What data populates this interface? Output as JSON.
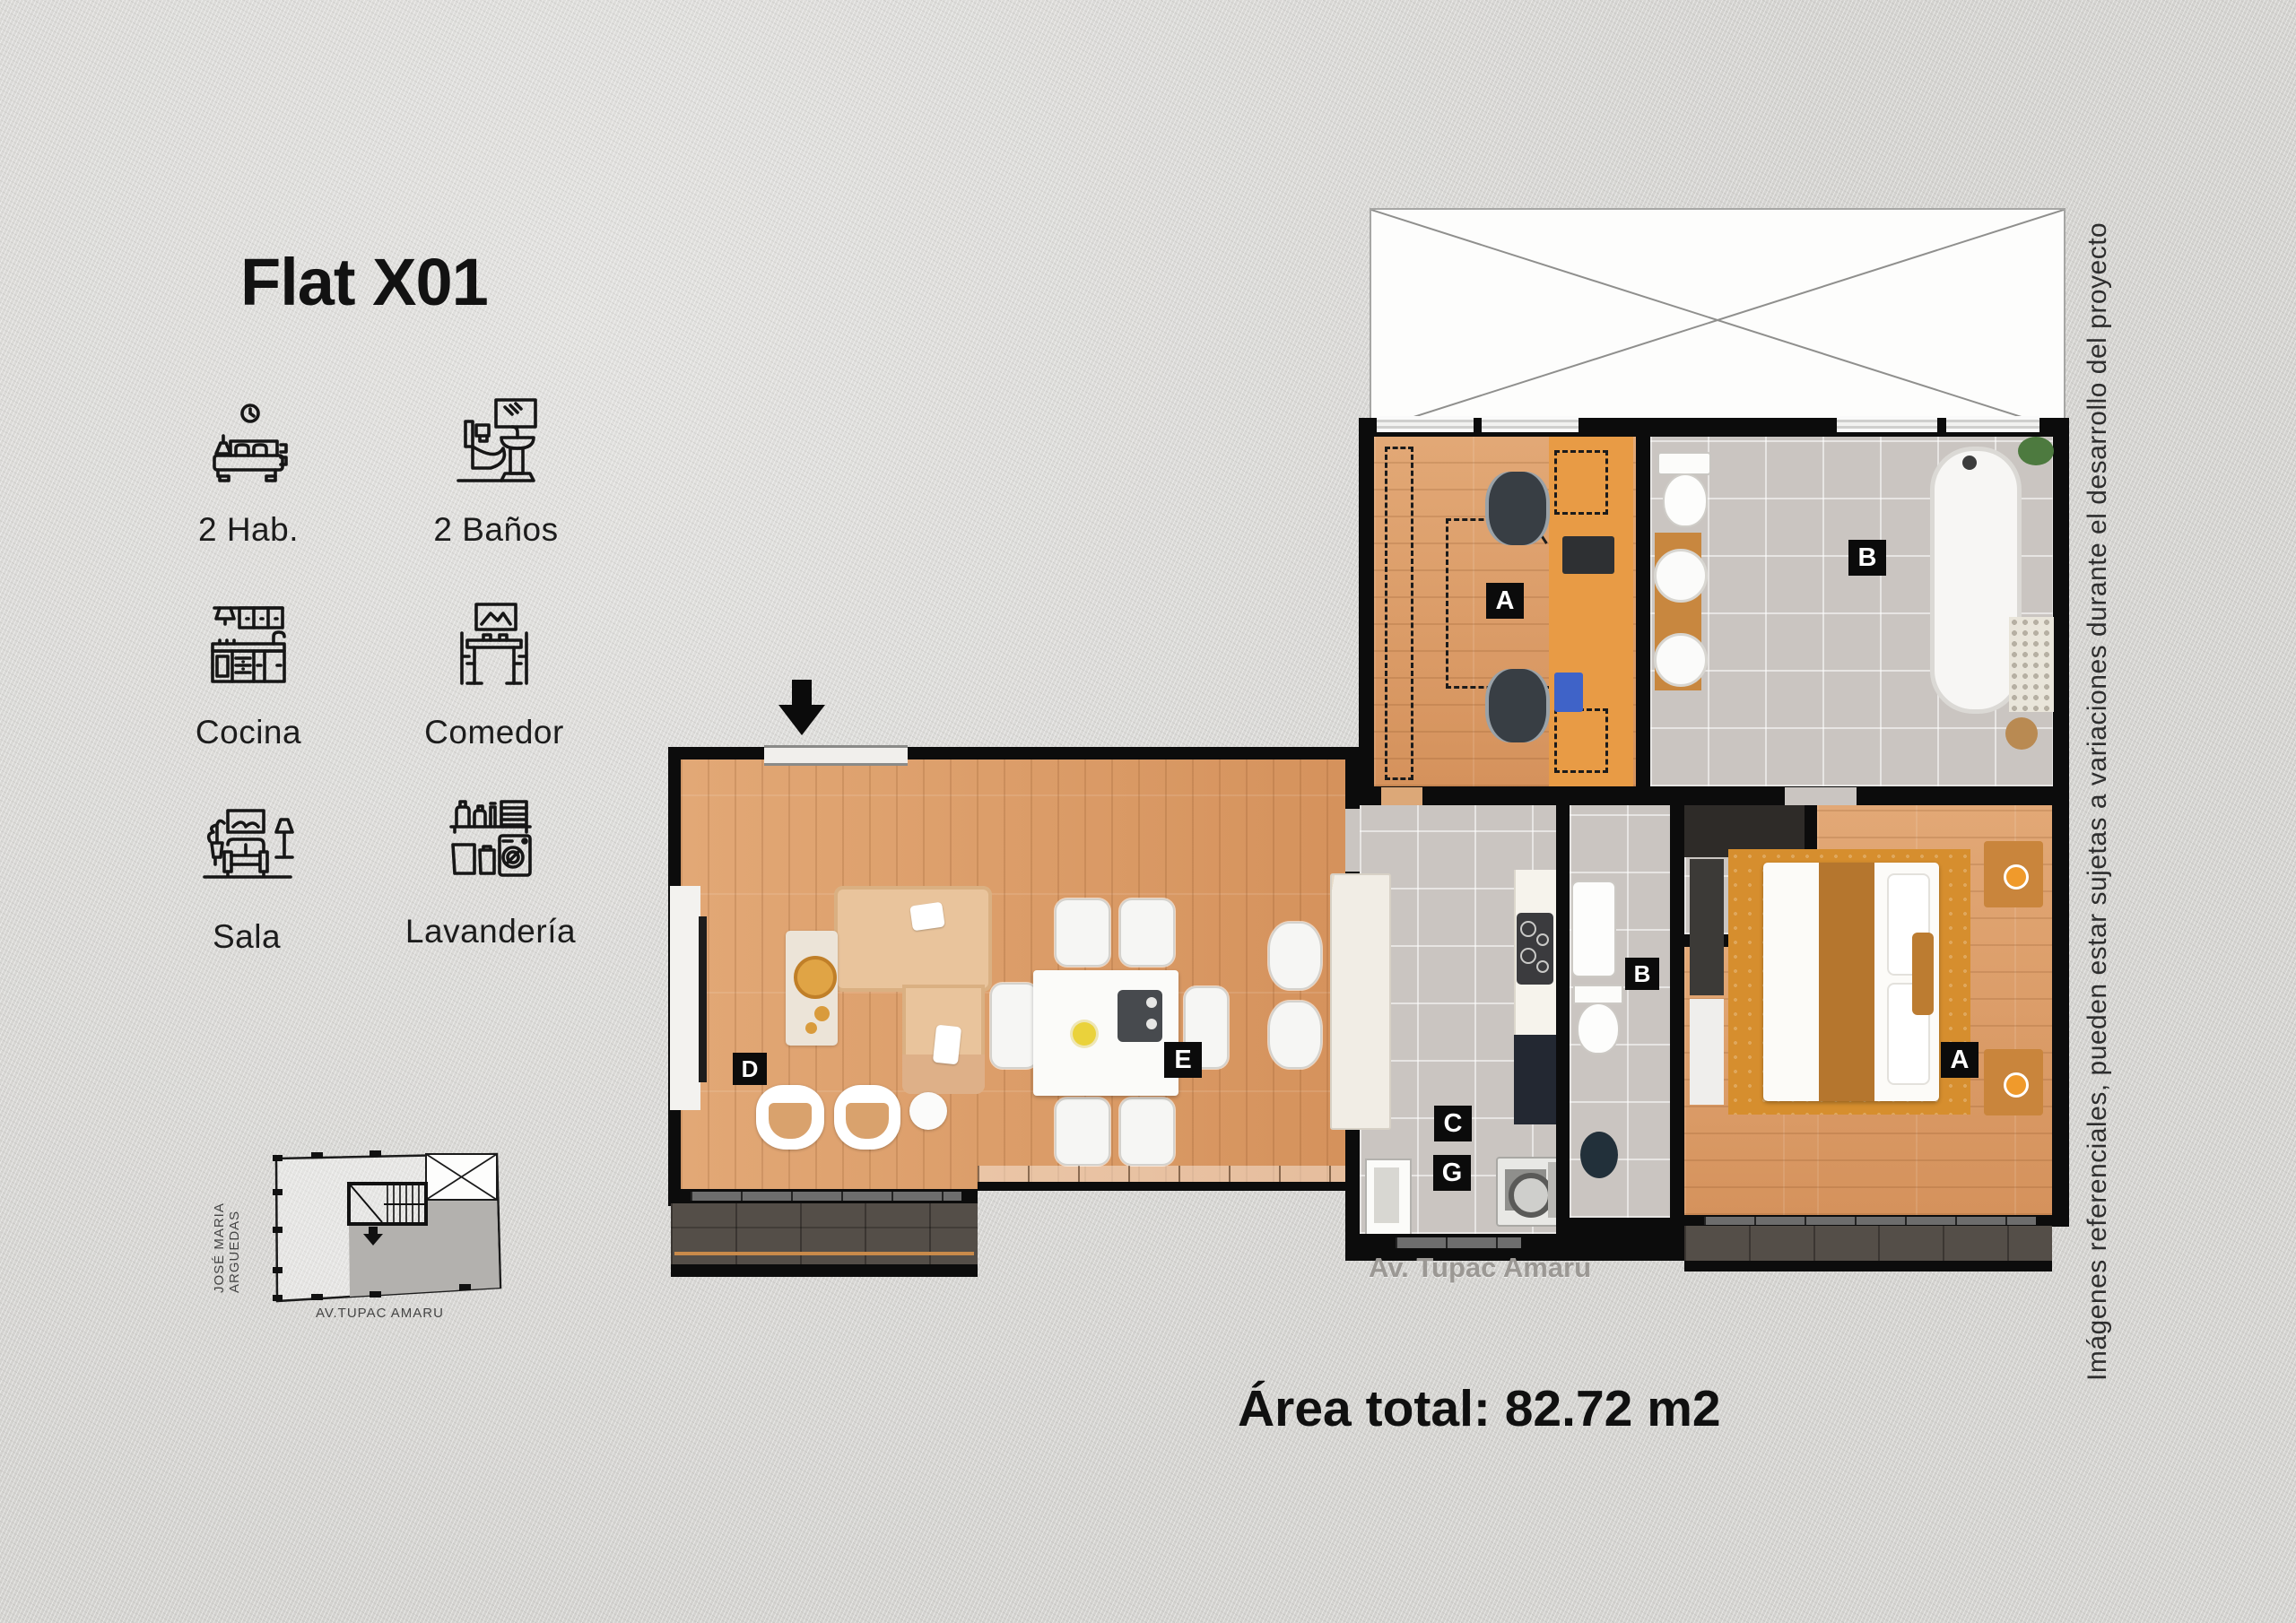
{
  "title": "Flat X01",
  "features": [
    {
      "label": "2 Hab.",
      "icon": "bed-clock-icon"
    },
    {
      "label": "2 Baños",
      "icon": "toilet-sink-icon"
    },
    {
      "label": "Cocina",
      "icon": "kitchen-icon"
    },
    {
      "label": "Comedor",
      "icon": "dining-icon"
    },
    {
      "label": "Sala",
      "icon": "sofa-icon"
    },
    {
      "label": "Lavandería",
      "icon": "laundry-icon"
    }
  ],
  "minimap": {
    "street_left": "JOSÉ MARIA ARGUEDAS",
    "street_bottom": "AV.TUPAC AMARU"
  },
  "plan": {
    "street_label": "Av. Tupac Amaru",
    "labels": {
      "bedroom_top": "A",
      "bath_top": "B",
      "kitchen": "C",
      "living": "D",
      "dining": "E",
      "laundry": "G",
      "bath_lower": "B",
      "bedroom_lower": "A"
    }
  },
  "area_total": "Área total: 82.72 m2",
  "disclaimer": "Imágenes referenciales, pueden estar sujetas a variaciones durante el desarrollo del proyecto",
  "colors": {
    "wall": "#0c0c0c",
    "wood": "#dda26d",
    "tile": "#cac5c1",
    "dark_tile": "#544e48",
    "desk_orange": "#e89b45",
    "rug_orange": "#d68e2e",
    "label_bg": "#0b0b0b",
    "background": "#d8d7d4"
  }
}
